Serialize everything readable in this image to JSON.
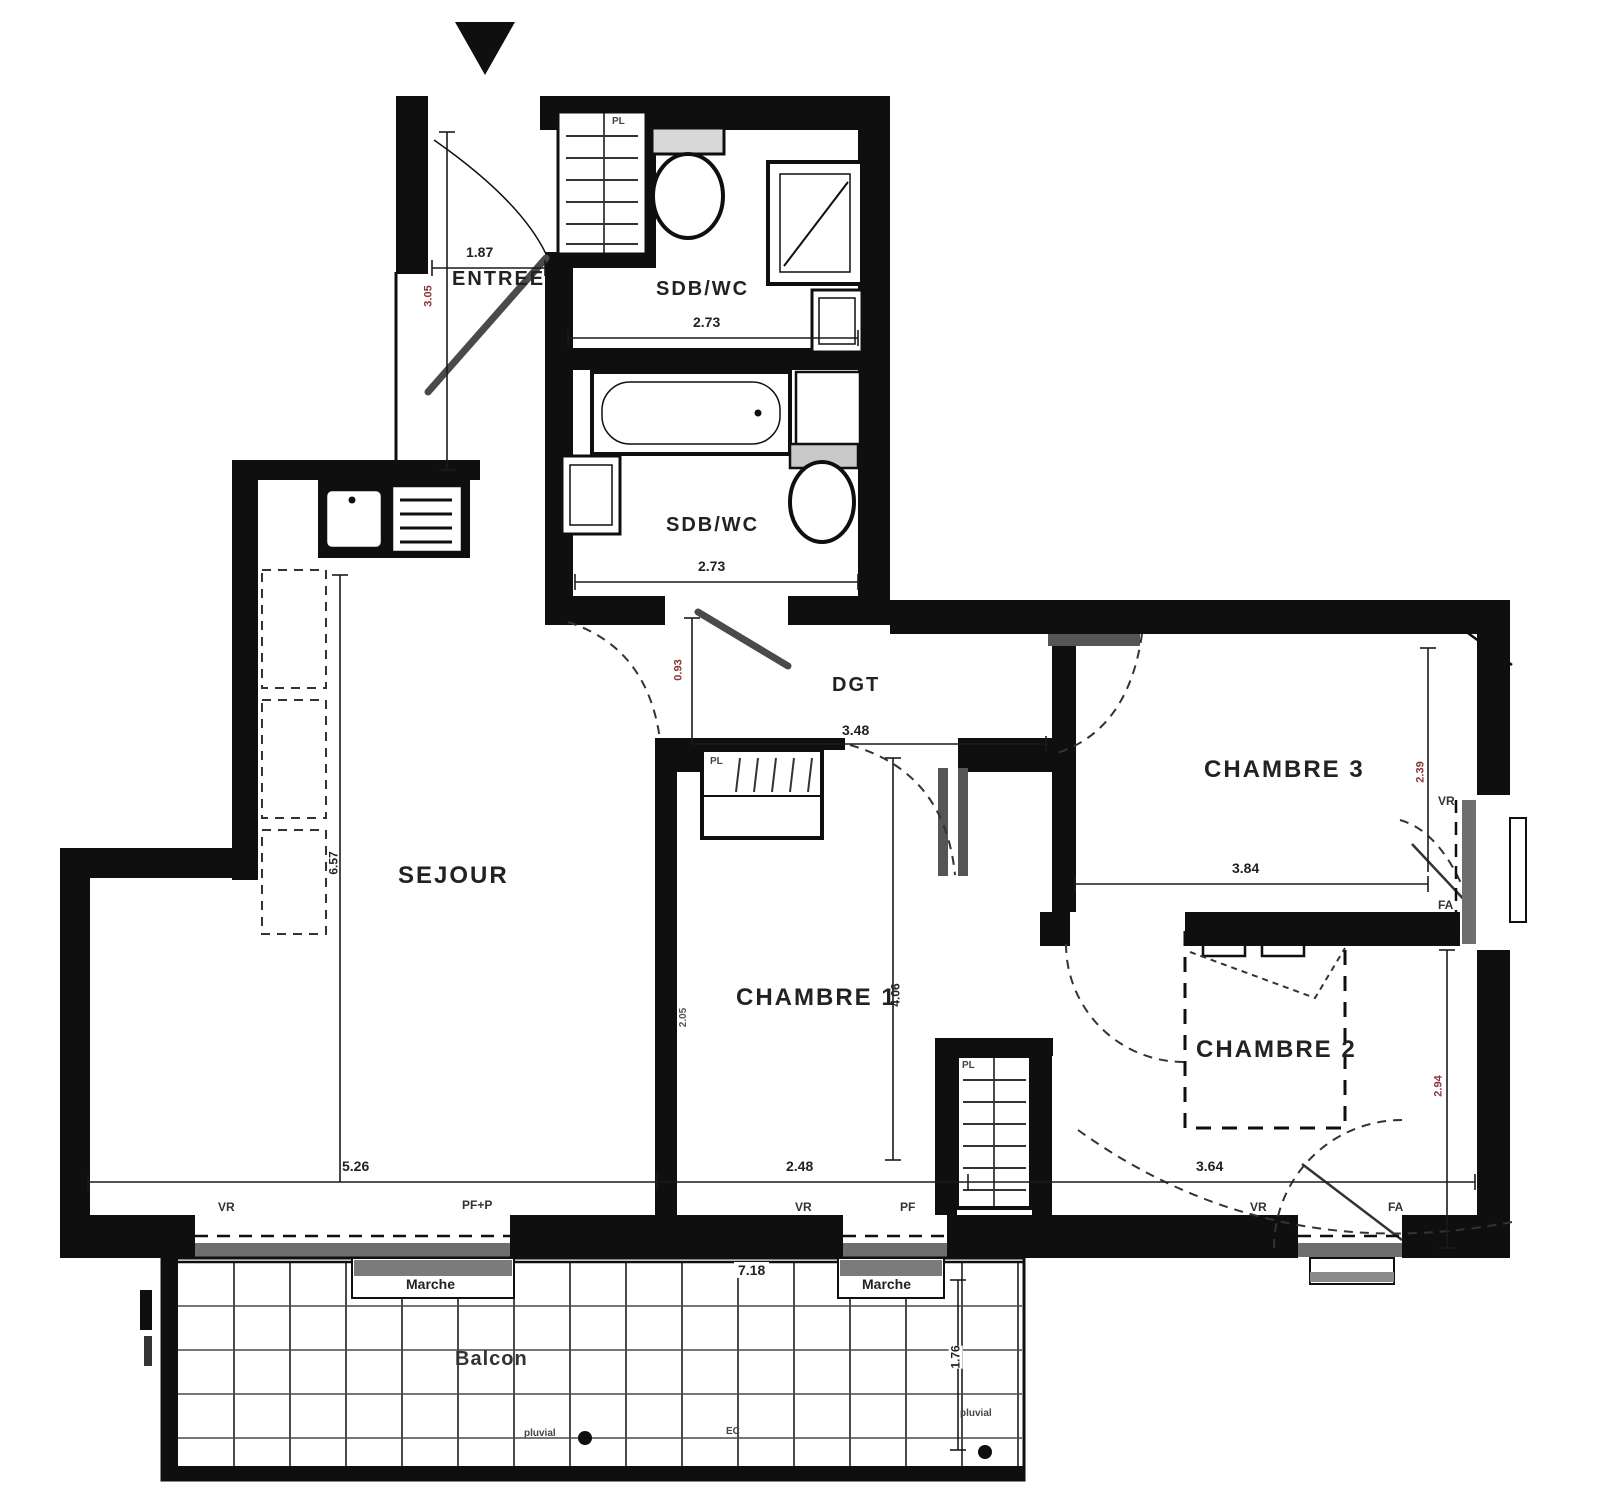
{
  "plan_title": "Floor plan",
  "rooms": {
    "entree": "ENTREE",
    "sdb1": "SDB/WC",
    "sdb2": "SDB/WC",
    "dgt": "DGT",
    "sejour": "SEJOUR",
    "chambre1": "CHAMBRE 1",
    "chambre2": "CHAMBRE 2",
    "chambre3": "CHAMBRE 3",
    "balcon": "Balcon"
  },
  "features": {
    "marche": "Marche",
    "pl": "PL",
    "ec": "EC",
    "pluvial": "pluvial"
  },
  "windows": {
    "sejour_vr": "VR",
    "sejour_type": "PF+P",
    "ch1_vr": "VR",
    "ch1_type": "PF",
    "ch2_vr": "VR",
    "ch2_type": "FA",
    "ch3_vr": "VR",
    "ch3_type": "FA"
  },
  "dims": {
    "entry_w": "1.87",
    "entry_h": "3.05",
    "sdb1_w": "2.73",
    "sdb2_w": "2.73",
    "dgt_w": "3.48",
    "dgt_h": "0.93",
    "sejour_w": "5.26",
    "sejour_h": "6.57",
    "ch1_w": "2.48",
    "ch1_h": "4.06",
    "ch1_side": "2.05",
    "ch2_w": "3.64",
    "ch2_h": "2.94",
    "ch3_w": "3.84",
    "ch3_h": "2.39",
    "balcon_w": "7.18",
    "balcon_h": "1.76"
  },
  "colors": {
    "wall": "#0f0f0f",
    "sill": "#6e6e6e",
    "dim_red": "#8b3434"
  }
}
